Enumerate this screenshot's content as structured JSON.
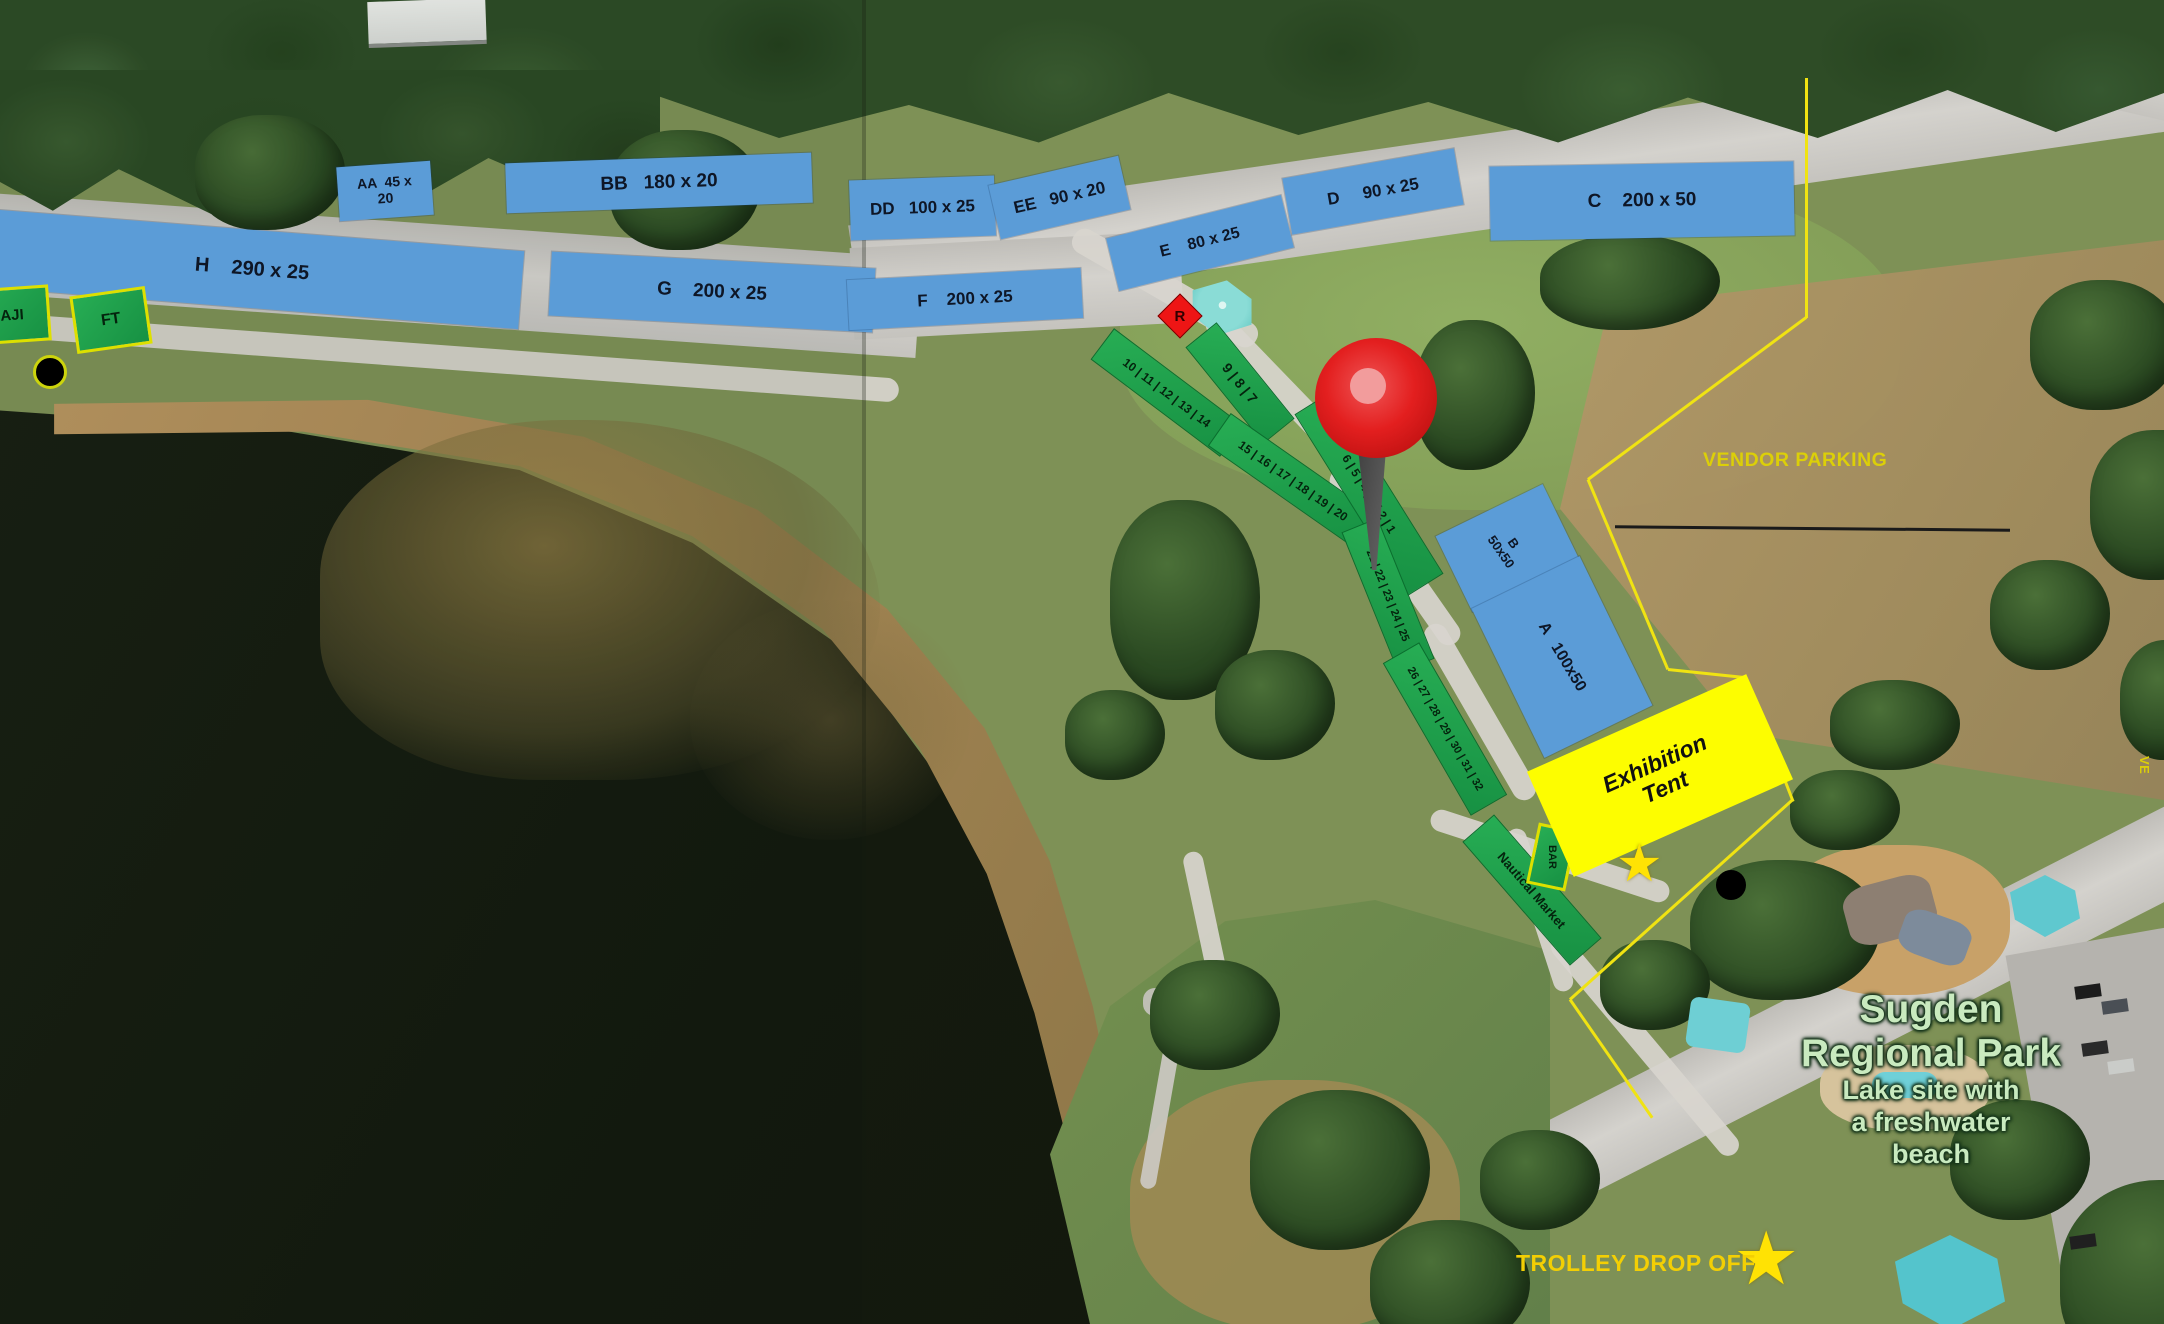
{
  "zones": {
    "AA": {
      "line1": "AA  45 x",
      "line2": "20"
    },
    "BB": {
      "text": "BB   180 x 20"
    },
    "H": {
      "text": "H    290 x 25"
    },
    "G": {
      "text": "G    200 x 25"
    },
    "DD": {
      "text": "DD   100 x 25"
    },
    "EE": {
      "text": "EE   90 x 20"
    },
    "F": {
      "text": "F    200 x 25"
    },
    "E": {
      "text": "E    80 x 25"
    },
    "D": {
      "text": "D     90 x 25"
    },
    "C": {
      "text": "C    200 x 50"
    },
    "B": {
      "line1": "B",
      "line2": "50x50"
    },
    "A": {
      "text": "A   100x50"
    }
  },
  "booths": {
    "strip_9_7": "9 | 8 | 7",
    "strip_10_14": "10 | 11 | 12 | 13 | 14",
    "strip_15_20": "15 | 16 | 17 | 18 | 19 | 20",
    "strip_6_1": "6 | 5 | 4 | 3 | 2 | 1",
    "strip_21_25": "21 | 22 | 23 | 24 | 25",
    "strip_26_32": "26 | 27 | 28 | 29 | 30 | 31 | 32",
    "nautical_market": "Nautical Market",
    "bar": "BAR",
    "ft": "FT",
    "aji": "AJI"
  },
  "markers": {
    "r_marker": "R"
  },
  "exhibition_tent": {
    "line1": "Exhibition",
    "line2": "Tent"
  },
  "labels": {
    "vendor_parking": "VENDOR PARKING",
    "trolley_drop_off": "TROLLEY DROP OFF",
    "edge_partial": "VE"
  },
  "place_label": {
    "line1": "Sugden",
    "line2": "Regional Park",
    "sub1": "Lake site with",
    "sub2": "a freshwater",
    "sub3": "beach"
  },
  "icons": {
    "star": "★"
  },
  "colors": {
    "zone_blue": "#5b9cd7",
    "booth_green": "#1fa24b",
    "tent_yellow": "#fdfd00",
    "boundary_yellow": "#f0e312",
    "label_yellow": "#dccf08",
    "pin_red": "#e31f1f",
    "marker_red": "#ee1515",
    "place_label_green": "#c9eabf"
  }
}
